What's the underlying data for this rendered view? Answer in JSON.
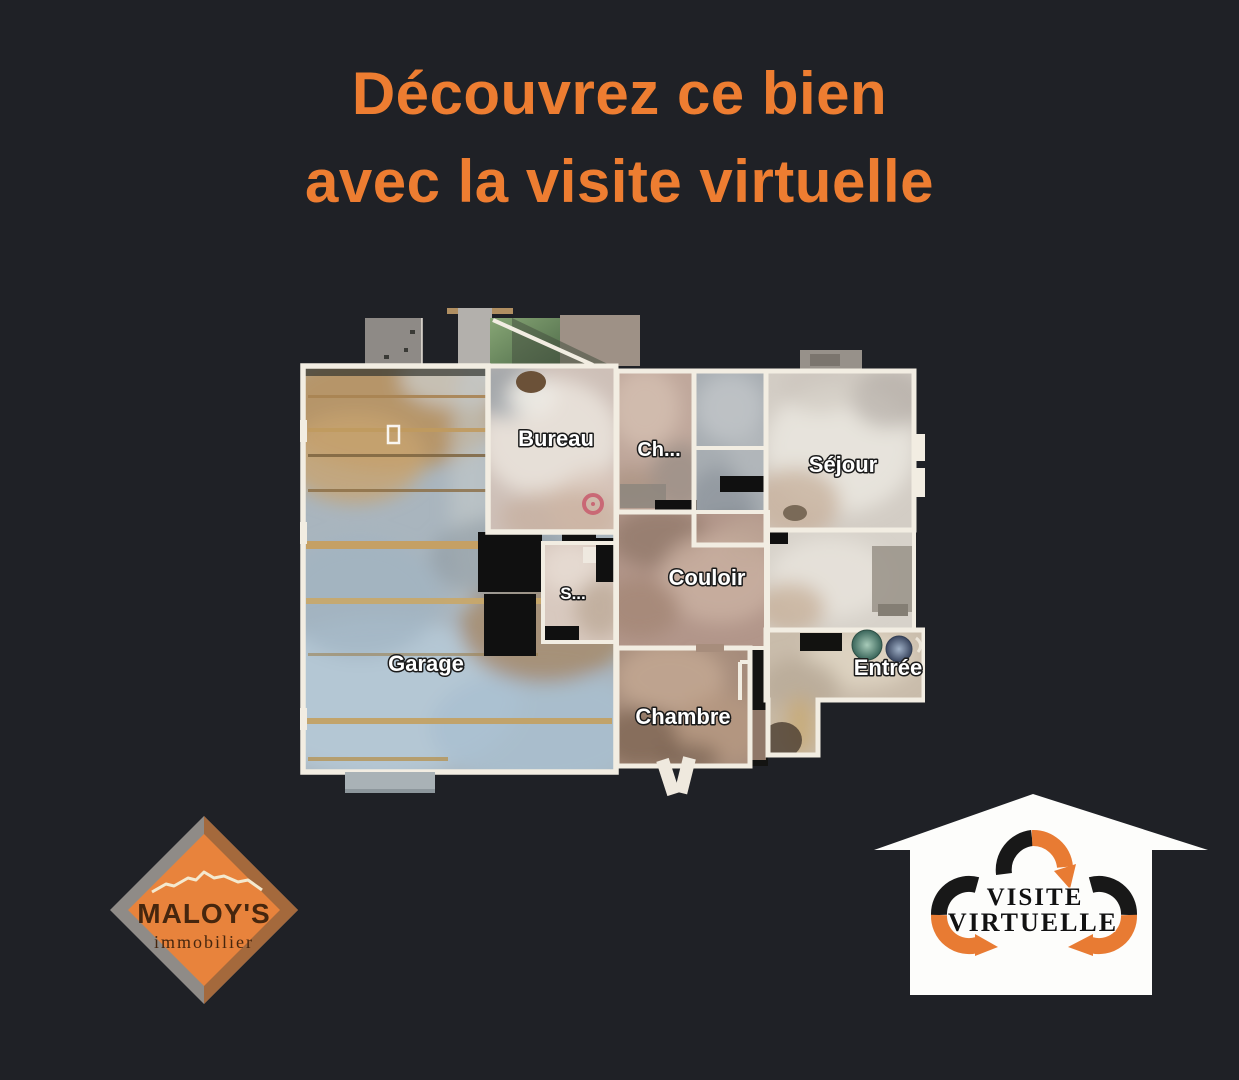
{
  "page": {
    "background_color": "#1f2126",
    "description": "Real-estate poster promoting a virtual tour, with a 3D scanned floor plan"
  },
  "title": {
    "line1": "Découvrez ce bien",
    "line2": "avec la visite virtuelle",
    "color": "#ed7d31"
  },
  "floorplan": {
    "wall_color": "#f2ede2",
    "marker_color": "#c96070",
    "rooms": [
      {
        "id": "garage",
        "label": "Garage"
      },
      {
        "id": "bureau",
        "label": "Bureau"
      },
      {
        "id": "chambre-2",
        "label": "Ch..."
      },
      {
        "id": "sejour",
        "label": "Séjour"
      },
      {
        "id": "couloir",
        "label": "Couloir"
      },
      {
        "id": "salle-eau",
        "label": "S..."
      },
      {
        "id": "chambre",
        "label": "Chambre"
      },
      {
        "id": "entree",
        "label": "Entrée"
      }
    ]
  },
  "agency_logo": {
    "name": "MALOY'S",
    "tagline": "immobilier",
    "diamond_color": "#e8833c",
    "border_left_color": "#8f8b87",
    "border_right_color": "#a4693c",
    "text_color": "#46260e",
    "roof_line_color": "#f4e9cf"
  },
  "virtual_tour_badge": {
    "line1": "VISITE",
    "line2": "VIRTUELLE",
    "house_color": "#fdfdfb",
    "arrow_dark_color": "#181818",
    "arrow_orange_color": "#e87b33"
  }
}
